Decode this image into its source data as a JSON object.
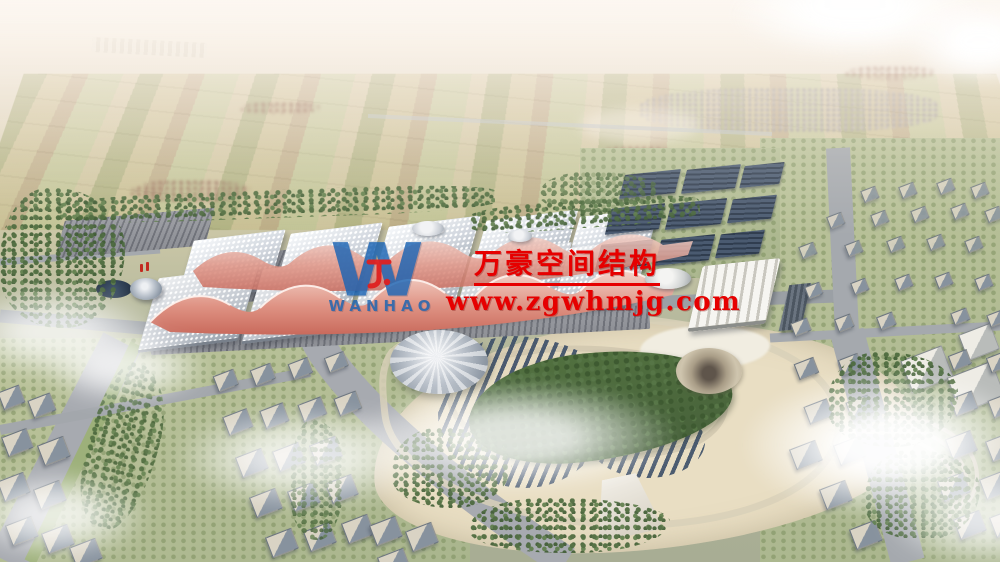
{
  "watermark": {
    "logo_letter": "W",
    "logo_subtext": "WANHAO",
    "company_name": "万豪空间结构",
    "website": "www.zgwhmjg.com",
    "text_color": "#e60000",
    "logo_color": "#1b64b4"
  },
  "scene": {
    "description": "Aerial architectural rendering of a large exhibition center with white cushion roofs and red wave-shaped membrane canopies, flanked by solar panel farms, a landscaped park with tent dome and photovoltaic rows, surrounding residential city blocks, distant farmland, and scattered clouds",
    "colors": {
      "sky_haze": "#f6efe8",
      "farmland": "#c8c298",
      "hall_roof": "#c8cdd4",
      "wave_canopy": "#d4796a",
      "solar_panel": "#3e5069",
      "park_ground": "#e9dec3",
      "forest": "#51703f",
      "road": "#9ba0a5"
    }
  }
}
